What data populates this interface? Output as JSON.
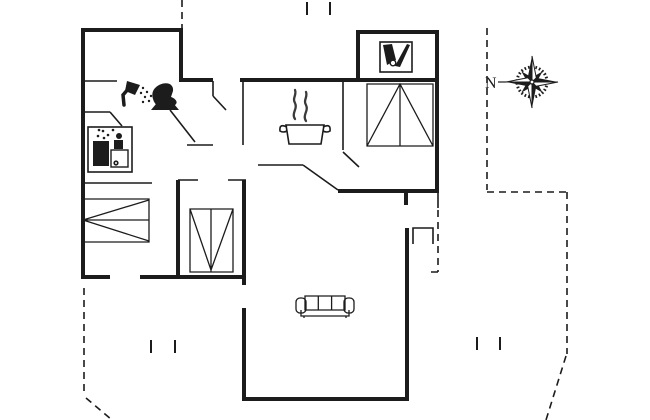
{
  "canvas": {
    "background": "#ffffff",
    "line_color": "#1c1c1c",
    "steam_color": "#3a3a3a"
  },
  "compass": {
    "north_label": "N"
  },
  "floor_plan": {
    "kind": "floor plan line drawing",
    "wall_style": "thick solid",
    "terrace_boundary_style": "dashed",
    "rooms": [
      {
        "name": "bathroom",
        "icons": [
          "shower-icon",
          "toilet-icon"
        ]
      },
      {
        "name": "utility-corner",
        "icons": [
          "washing-machine-icon"
        ]
      },
      {
        "name": "kitchen",
        "icons": [
          "cooking-pot-icon",
          "steam-icon"
        ]
      },
      {
        "name": "sauna-room",
        "icons": [
          "sauna-icon"
        ]
      },
      {
        "name": "bedroom-left",
        "furniture": [
          "double-bed"
        ]
      },
      {
        "name": "bedroom-middle",
        "furniture": [
          "single-bed"
        ]
      },
      {
        "name": "bedroom-top-right",
        "furniture": [
          "double-bed"
        ]
      },
      {
        "name": "living-room",
        "furniture": [
          "sofa"
        ]
      }
    ],
    "counts": {
      "beds": 3,
      "sofas": 1,
      "terrace_post_tick_pairs": 3
    }
  }
}
